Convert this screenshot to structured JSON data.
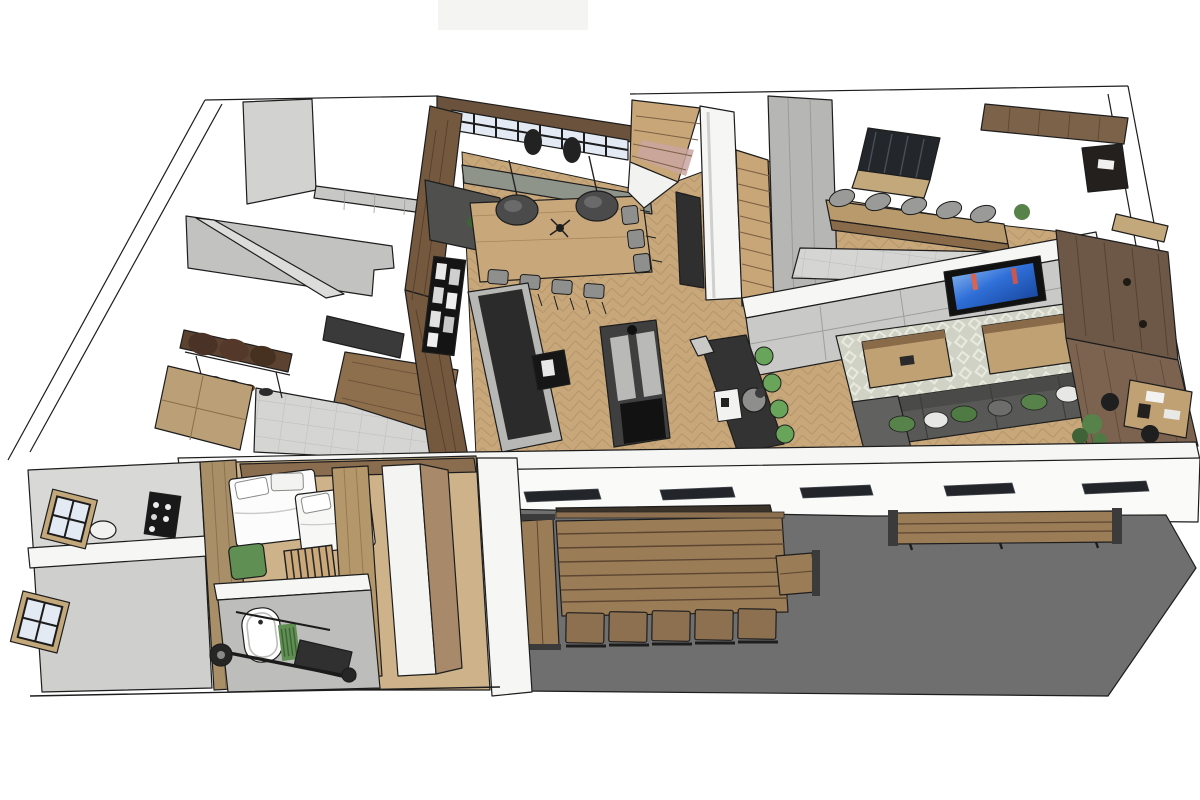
{
  "scene": {
    "type": "3d-floorplan-render",
    "style": "sketchup-cutaway-top-view",
    "objects": [
      "window-wall",
      "dining-table",
      "pendant-lamps",
      "dining-chairs",
      "sideboard",
      "wood-feature-wall",
      "shelf-unit",
      "kitchen-island",
      "prep-island",
      "bar-island",
      "green-bar-stools",
      "staircase",
      "under-stair-closet",
      "skylight",
      "mezzanine-beam",
      "breakfast-bar",
      "bar-stools",
      "media-wall",
      "wall-tv",
      "area-rug",
      "coffee-tables",
      "sofa",
      "throw-pillows",
      "office-wood-wall",
      "office-desk",
      "desk-chairs",
      "plants",
      "entry-bench",
      "coat-rack",
      "shoe-row",
      "entry-cabinet",
      "garage-slabs",
      "bedroom-beds",
      "pillows",
      "crib",
      "kids-chair",
      "wardrobe",
      "bathtub",
      "bath-mat",
      "barbell",
      "gym-bench",
      "side-windows",
      "wine-rack",
      "round-table",
      "terrace-floor",
      "terrace-picnic-table",
      "terrace-chairs",
      "terrace-benches",
      "terrace-side-table",
      "roof-slits",
      "front-wall"
    ]
  },
  "palette": {
    "white": "#ffffff",
    "wall": "#f6f6f5",
    "wallFace": "#e3e3e1",
    "concreteLight": "#d2d2d0",
    "concrete": "#c2c2c0",
    "tileStrip": "#c7c7c5",
    "floorWood": "#c8a87b",
    "bedroomWood": "#cdb28a",
    "plankWood": "#8d6f4e",
    "woodWallDark": "#74593f",
    "woodHeader": "#6b523c",
    "woodLight": "#c0a173",
    "mezzanineWood": "#6d5847",
    "terrace": "#6e6f6e",
    "terraceTable": "#9a7c57",
    "terraceChair": "#8d7050",
    "islandDark": "#343434",
    "islandSide": "#b7b7b5",
    "charcoal": "#2e2e2e",
    "closetGray": "#b6b6b4",
    "tileGray": "#d5d5d3",
    "benchGray": "#8f948b",
    "barWood": "#b99a6d",
    "stoolGray": "#9a9a98",
    "sofa": "#585856",
    "rug": "#cfd2c4",
    "green": "#57824a",
    "stoolGreen": "#68a55b",
    "tvFrame": "#111111",
    "tvBlue": "#2f6fd8",
    "windowPane": "#e4eaf4",
    "frameDark": "#1c1c1c",
    "bedWhite": "#fcfcfc",
    "bathGray": "#bdbdbb",
    "maroon": "#6e3a4a",
    "outline": "#1d1d1d"
  }
}
